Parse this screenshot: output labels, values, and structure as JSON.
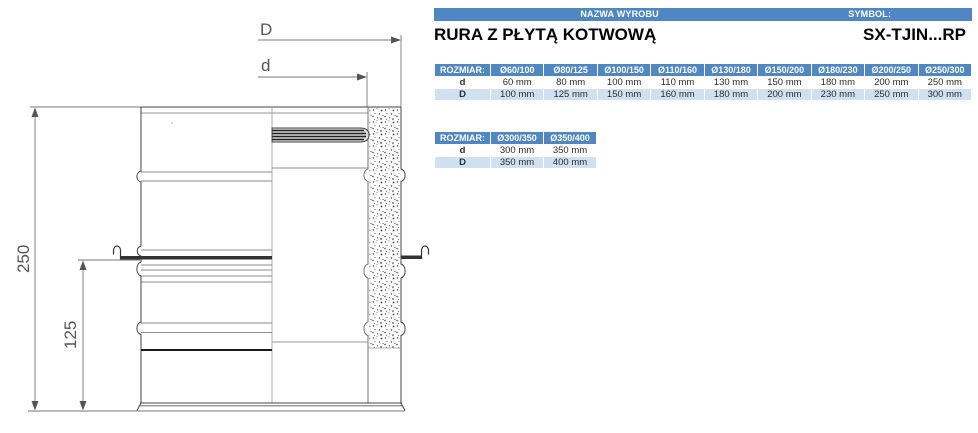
{
  "header": {
    "name_label": "NAZWA WYROBU",
    "symbol_label": "SYMBOL:",
    "product_name": "RURA Z PŁYTĄ KOTWOWĄ",
    "symbol_value": "SX-TJIN...RP"
  },
  "table1": {
    "header": [
      "ROZMIAR:",
      "Ø60/100",
      "Ø80/125",
      "Ø100/150",
      "Ø110/160",
      "Ø130/180",
      "Ø150/200",
      "Ø180/230",
      "Ø200/250",
      "Ø250/300"
    ],
    "row_d": [
      "d",
      "60 mm",
      "80 mm",
      "100 mm",
      "110 mm",
      "130 mm",
      "150 mm",
      "180 mm",
      "200 mm",
      "250 mm"
    ],
    "row_D": [
      "D",
      "100 mm",
      "125 mm",
      "150 mm",
      "160 mm",
      "180 mm",
      "200 mm",
      "230 mm",
      "250 mm",
      "300 mm"
    ]
  },
  "table2": {
    "header": [
      "ROZMIAR:",
      "Ø300/350",
      "Ø350/400"
    ],
    "row_d": [
      "d",
      "300 mm",
      "350 mm"
    ],
    "row_D": [
      "D",
      "350 mm",
      "400 mm"
    ]
  },
  "drawing": {
    "labels": {
      "outer_diameter": "D",
      "inner_diameter": "d",
      "total_height": "250",
      "plate_height": "125"
    }
  },
  "colors": {
    "table_header_blue": "#4e87c4",
    "table_row_light_blue": "#cfe0f1",
    "drawing_line_gray": "#555555"
  }
}
